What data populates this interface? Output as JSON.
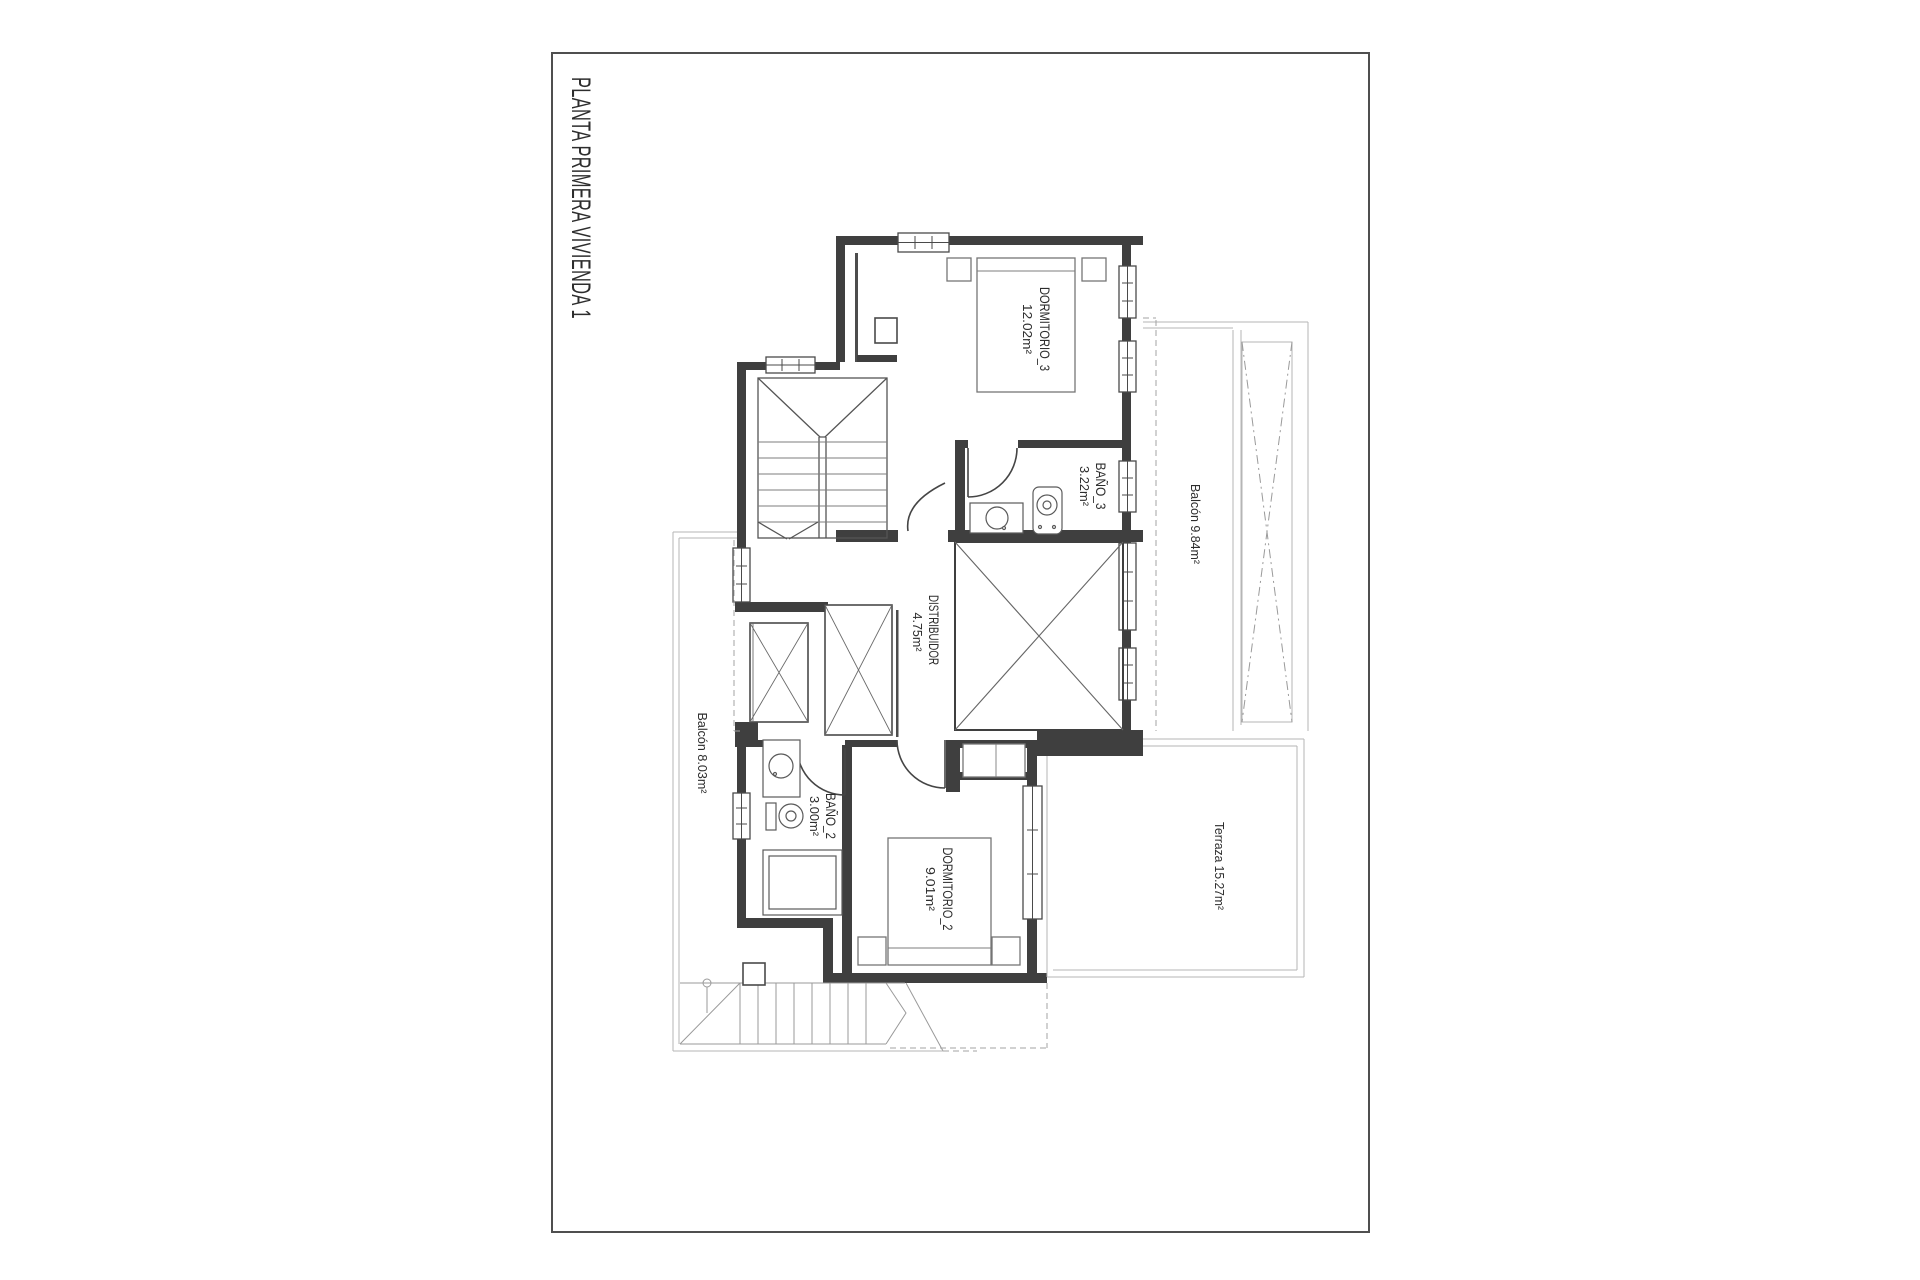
{
  "drawing": {
    "title": "PLANTA PRIMERA VIVIENDA 1",
    "labels": {
      "dormitorio3": {
        "name": "DORMITORIO_3",
        "area": "12.02m²"
      },
      "bano3": {
        "name": "BAÑO_3",
        "area": "3.22m²"
      },
      "balcon_top": {
        "text": "Balcón 9.84m²"
      },
      "distribuidor": {
        "name": "DISTRIBUIDOR",
        "area": "4.75m²"
      },
      "balcon_left": {
        "text": "Balcón 8.03m²"
      },
      "bano2": {
        "name": "BAÑO_2",
        "area": "3.00m²"
      },
      "dormitorio2": {
        "name": "DORMITORIO_2",
        "area": "9.01m²"
      },
      "terraza": {
        "text": "Terraza 15.27m²"
      }
    },
    "colors": {
      "wall": "#3f3f3f",
      "light_line": "#b5b5b5",
      "dashed_line": "#a3a3a3",
      "text": "#2d2d2d",
      "frame": "#4f4f4f"
    }
  }
}
